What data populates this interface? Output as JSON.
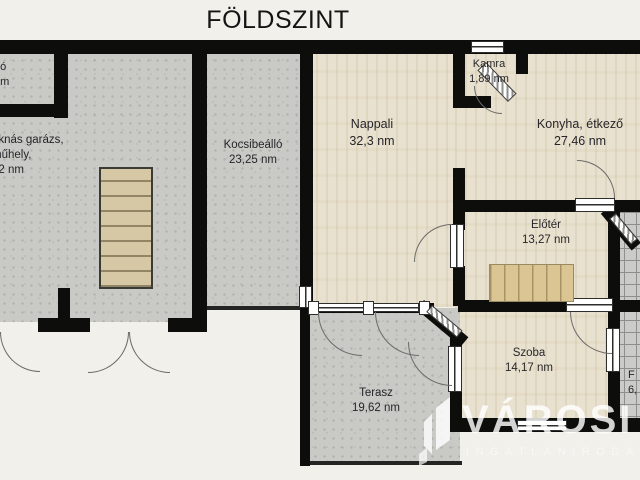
{
  "title": "FÖLDSZINT",
  "rooms": {
    "top_left_partial": {
      "name": "dó",
      "area": "nm"
    },
    "garage": {
      "line1": "aknás garázs,",
      "line2": "műhely,",
      "line3": "52 nm"
    },
    "kocsibeallo": {
      "name": "Kocsibeálló",
      "area": "23,25 nm"
    },
    "nappali": {
      "name": "Nappali",
      "area": "32,3 nm"
    },
    "kamra": {
      "name": "Kamra",
      "area": "1,89 nm"
    },
    "konyha": {
      "name": "Konyha, étkező",
      "area": "27,46 nm"
    },
    "eloter": {
      "name": "Előtér",
      "area": "13,27 nm"
    },
    "szoba": {
      "name": "Szoba",
      "area": "14,17 nm"
    },
    "furdo_partial": {
      "name": "F",
      "area": "6,"
    },
    "terasz": {
      "name": "Terasz",
      "area": "19,62 nm"
    }
  },
  "watermark": {
    "brand": "VÁROSI",
    "subtitle": "INGATLANIRODA"
  },
  "colors": {
    "background": "#f0efe9",
    "wall": "#0d0d0b",
    "concrete": "#c9c9c6",
    "wood_floor": "#e9e1cf",
    "stairs": "#dac593",
    "tile": "#cbcbc9",
    "watermark_text": "#ffffff"
  }
}
